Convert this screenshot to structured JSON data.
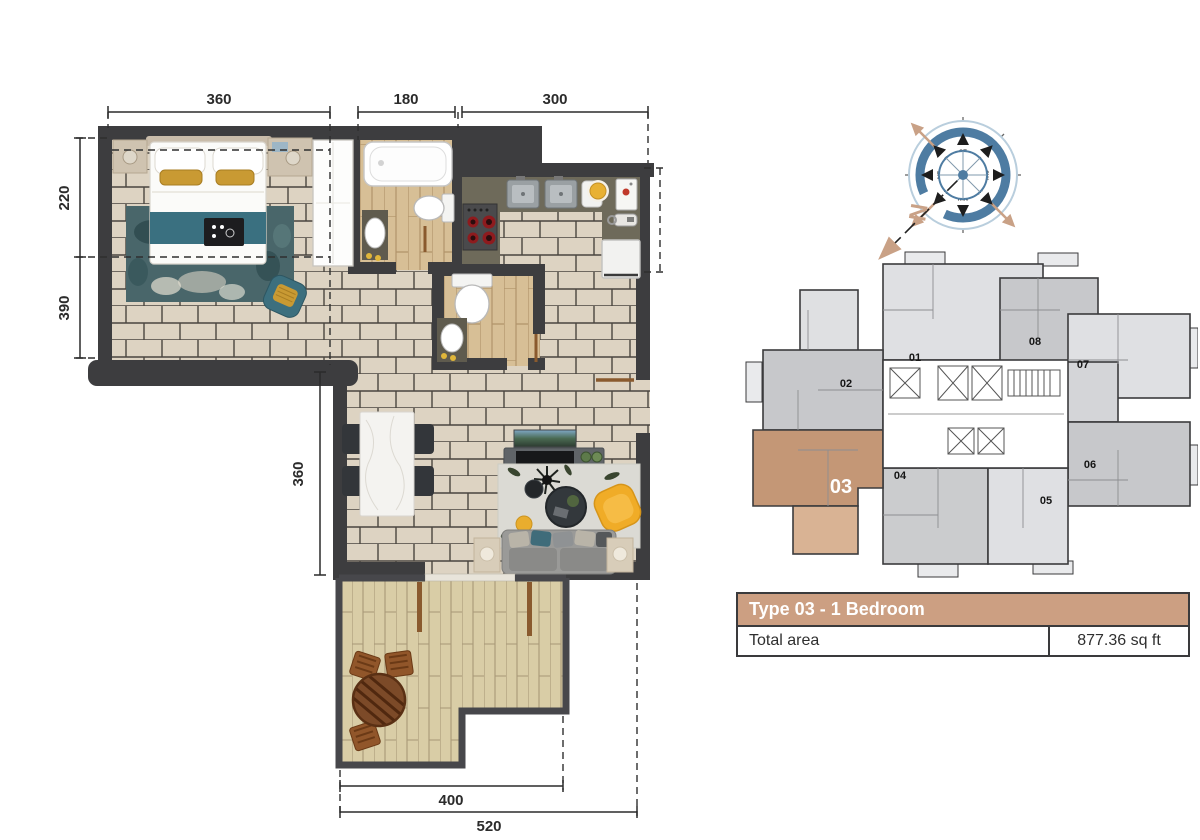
{
  "title": "Type 03 - 1 Bedroom floor plan",
  "dims": {
    "bedroom_width": "360",
    "bath_width": "180",
    "kitchen_width": "300",
    "left_upper": "220",
    "left_lower": "390",
    "living_height": "360",
    "terrace_width": "400",
    "overall_width": "520"
  },
  "compass": {
    "north": "N",
    "dirs": [
      "N",
      "NE",
      "E",
      "SE",
      "S",
      "SW",
      "W",
      "NW"
    ]
  },
  "keyplan": {
    "units": [
      {
        "id": "01",
        "highlighted": false
      },
      {
        "id": "02",
        "highlighted": false
      },
      {
        "id": "03",
        "highlighted": true
      },
      {
        "id": "04",
        "highlighted": false
      },
      {
        "id": "05",
        "highlighted": false
      },
      {
        "id": "06",
        "highlighted": false
      },
      {
        "id": "07",
        "highlighted": false
      },
      {
        "id": "08",
        "highlighted": false
      }
    ],
    "highlighted_unit": "03"
  },
  "info_table": {
    "header": "Type 03 - 1 Bedroom",
    "area_label": "Total area",
    "area_value": "877.36 sq ft"
  },
  "colors": {
    "wall": "#3d3d3f",
    "unit_highlight": "#c49776",
    "unit_highlight_balcony": "#d9b394",
    "table_header_bg": "#cc9f82",
    "accent_teal": "#3a7080",
    "accent_yellow": "#f0ac27",
    "compass_blue": "#4e7ca2",
    "compass_tan": "#c9a186"
  }
}
